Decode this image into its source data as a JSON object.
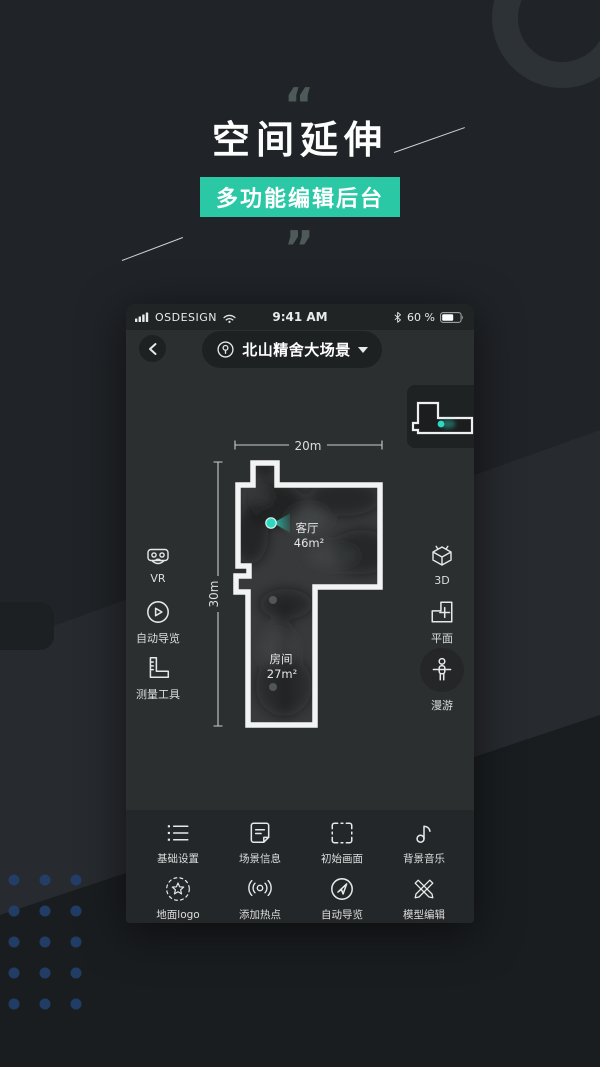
{
  "colors": {
    "accent": "#2bc8a6",
    "camera_marker": "#2fd6c0",
    "background": "#202327",
    "phone_screen": "#2c2f30",
    "dot_grid_blue": "#22406d",
    "wall_white": "#f2f4f4"
  },
  "hero": {
    "quote_open": "“",
    "quote_close": "”",
    "title": "空间延伸",
    "badge": "多功能编辑后台"
  },
  "phone": {
    "status_bar": {
      "carrier": "OSDESIGN",
      "time": "9:41 AM",
      "battery_percent": "60 %",
      "icons": [
        "signal-bars-icon",
        "wifi-icon",
        "bluetooth-icon",
        "battery-icon"
      ]
    },
    "header": {
      "back_icon": "chevron-left-icon",
      "scene_icon": "location-pin-icon",
      "scene_name": "北山精舍大场景",
      "dropdown_icon": "caret-down-icon"
    },
    "minimap": {
      "marker_icon": "camera-position-dot"
    },
    "floorplan": {
      "width_label": "20m",
      "height_label": "30m",
      "rooms": [
        {
          "name": "客厅",
          "area": "46m²"
        },
        {
          "name": "房间",
          "area": "27m²"
        }
      ],
      "marker_icon": "camera-position-cone"
    },
    "left_tools": [
      {
        "label": "VR",
        "icon": "vr-goggles-icon"
      },
      {
        "label": "自动导览",
        "icon": "play-circle-icon"
      },
      {
        "label": "测量工具",
        "icon": "ruler-square-icon"
      }
    ],
    "right_tools": [
      {
        "label": "3D",
        "icon": "cube-3d-icon"
      },
      {
        "label": "平面",
        "icon": "floorplan-icon"
      },
      {
        "label": "漫游",
        "icon": "person-walk-icon",
        "active": true
      }
    ],
    "toolbar": {
      "row1": [
        {
          "label": "基础设置",
          "icon": "list-settings-icon"
        },
        {
          "label": "场景信息",
          "icon": "note-info-icon"
        },
        {
          "label": "初始画面",
          "icon": "frame-corners-icon"
        },
        {
          "label": "背景音乐",
          "icon": "music-note-icon"
        }
      ],
      "row2": [
        {
          "label": "地面logo",
          "icon": "star-dashed-circle-icon"
        },
        {
          "label": "添加热点",
          "icon": "hotspot-waves-icon"
        },
        {
          "label": "自动导览",
          "icon": "navigation-arrow-icon"
        },
        {
          "label": "模型编辑",
          "icon": "crossed-pens-icon"
        }
      ]
    }
  }
}
